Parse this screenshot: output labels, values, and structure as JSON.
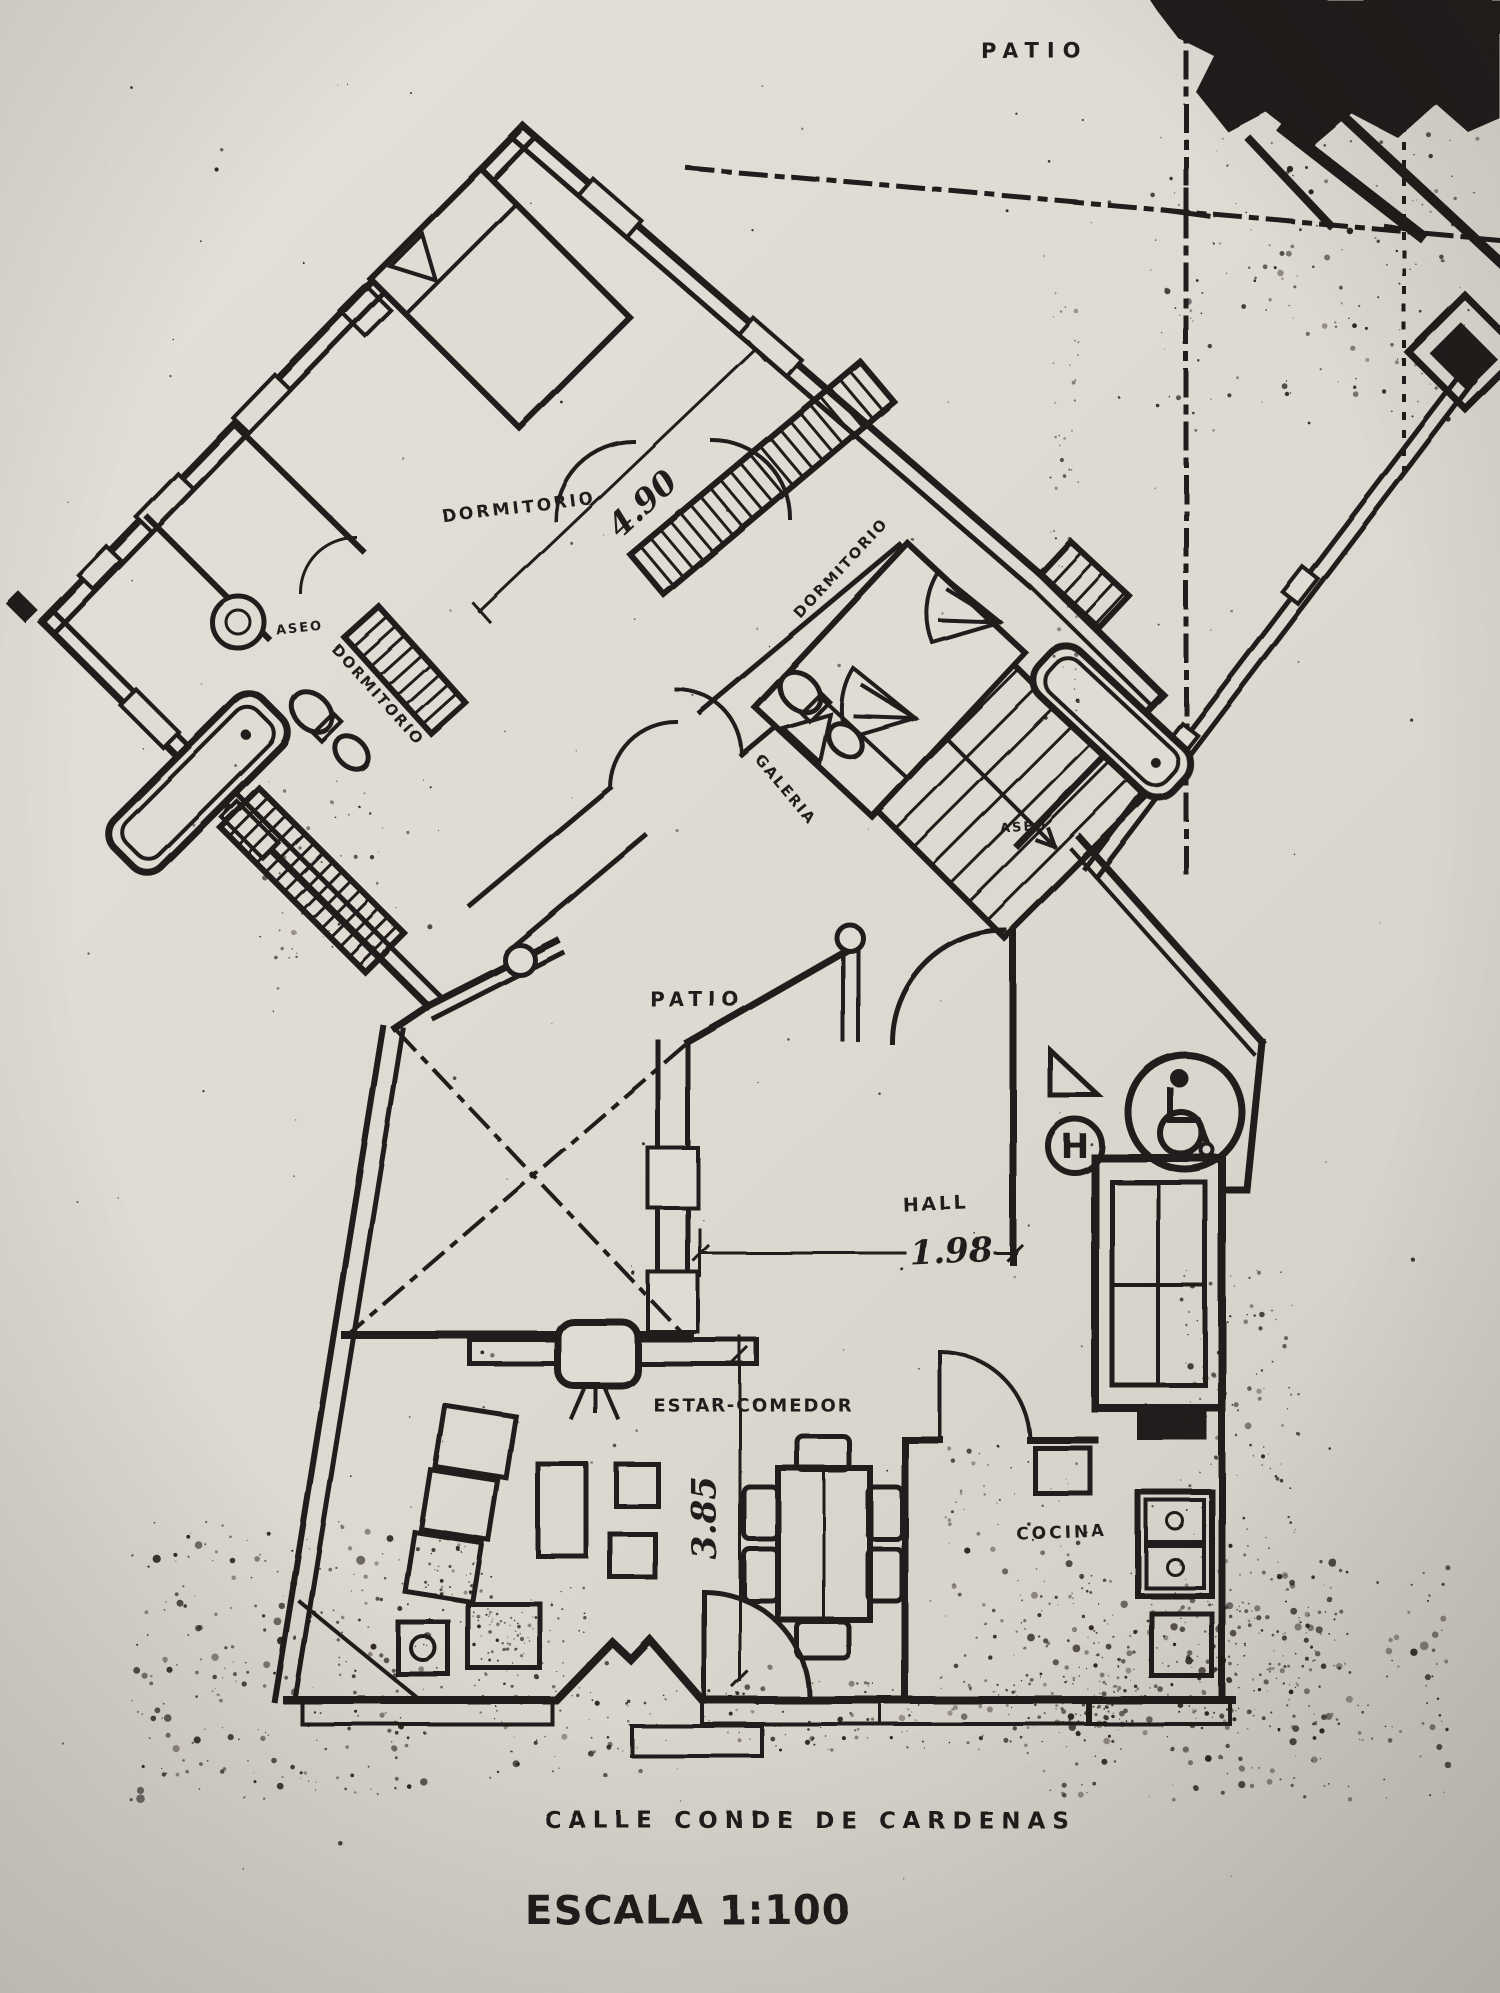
{
  "document": {
    "street_label": "CALLE CONDE DE CARDENAS",
    "scale_label": "ESCALA 1:100"
  },
  "rooms": {
    "patio_top": "PATIO",
    "patio_court": "PATIO",
    "dormitorio_main": "DORMITORIO",
    "dormitorio_right": "DORMITORIO",
    "dormitorio_left": "DORMITORIO",
    "aseo_left": "ASEO",
    "aseo_right": "ASEO",
    "galeria": "GALERIA",
    "hall": "HALL",
    "estar_comedor": "ESTAR-COMEDOR",
    "cocina": "COCINA"
  },
  "dimensions": {
    "bedroom_width": "4.90",
    "hall_width": "1.98",
    "living_depth": "3.85"
  },
  "symbols": {
    "elevator_letter": "H",
    "wheelchair_icon": "wheelchair-accessibility-symbol"
  },
  "colors": {
    "ink": "#221f1a",
    "paper": "#e0dcd4"
  }
}
